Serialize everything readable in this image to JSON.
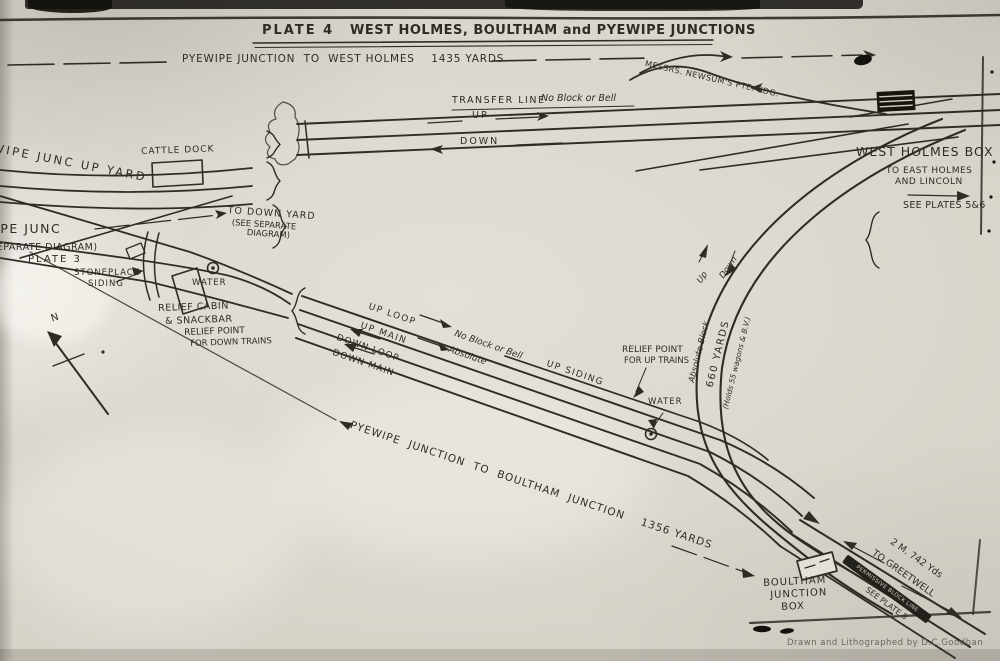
{
  "colors": {
    "paper": "#d8d4ca",
    "ink": "#2f2c26",
    "faded": "#6a665c"
  },
  "header": {
    "plate": "PLATE 4",
    "title": "WEST HOLMES, BOULTHAM and PYEWIPE JUNCTIONS"
  },
  "routes": {
    "top": "PYEWIPE JUNCTION  TO  WEST HOLMES    1435 YARDS",
    "diagonal": "PYEWIPE  JUNCTION  TO  BOULTHAM  JUNCTION    1356 YARDS"
  },
  "labels": {
    "newsums_siding": "MESSRS. NEWSUM'S PTE. SDG.",
    "transfer_line": "TRANSFER LINE",
    "no_block_or_bell_top": "No Block or Bell",
    "up_top": "UP",
    "down_top": "DOWN",
    "west_holmes_box": "WEST HOLMES BOX",
    "to_east_holmes_1": "TO EAST HOLMES",
    "to_east_holmes_2": "AND LINCOLN",
    "see_plates_56": "SEE PLATES 5&6",
    "pyewipe_up_yard": "PYEWIPE JUNC UP YARD",
    "cattle_dock": "CATTLE DOCK",
    "to_down_yard_1": "TO DOWN YARD",
    "to_down_yard_2": "(SEE SEPARATE",
    "to_down_yard_3": "DIAGRAM)",
    "pyewipe_junc": "PYEWIPE JUNC",
    "separate_diagram": "(SEPARATE DIAGRAM)",
    "plate_3": "PLATE 3",
    "stoneplace_1": "STONEPLACE",
    "stoneplace_2": "SIDING",
    "water_left": "WATER",
    "relief_cabin_1": "RELIEF CABIN",
    "relief_cabin_2": "& SNACKBAR",
    "relief_point_down_1": "RELIEF POINT",
    "relief_point_down_2": "FOR DOWN TRAINS",
    "north": "N",
    "up_loop": "UP LOOP",
    "up_main": "UP MAIN",
    "down_loop": "DOWN LOOP",
    "down_main": "DOWN MAIN",
    "no_block_or_bell_mid": "No Block or Bell",
    "absolute_mid": "Absolute",
    "up_siding": "UP SIDING",
    "relief_point_up_1": "RELIEF POINT",
    "relief_point_up_2": "FOR UP TRAINS",
    "water_mid": "WATER",
    "curve_up": "Up",
    "curve_down": "Down",
    "absolute_block": "Absolute Block",
    "yards_660": "660 YARDS",
    "holds_wagons": "(Holds 55 wagons & B.V.)",
    "greetwell_1": "2 M. 742 Yds",
    "greetwell_2": "TO GREETWELL",
    "permissive_block": "PERMISSIVE BLOCK LINE",
    "see_plate_8": "SEE PLATE 8",
    "boultham_1": "BOULTHAM",
    "boultham_2": "JUNCTION",
    "boultham_3": "BOX"
  },
  "credit": "Drawn and Lithographed by D.C.Goodban"
}
